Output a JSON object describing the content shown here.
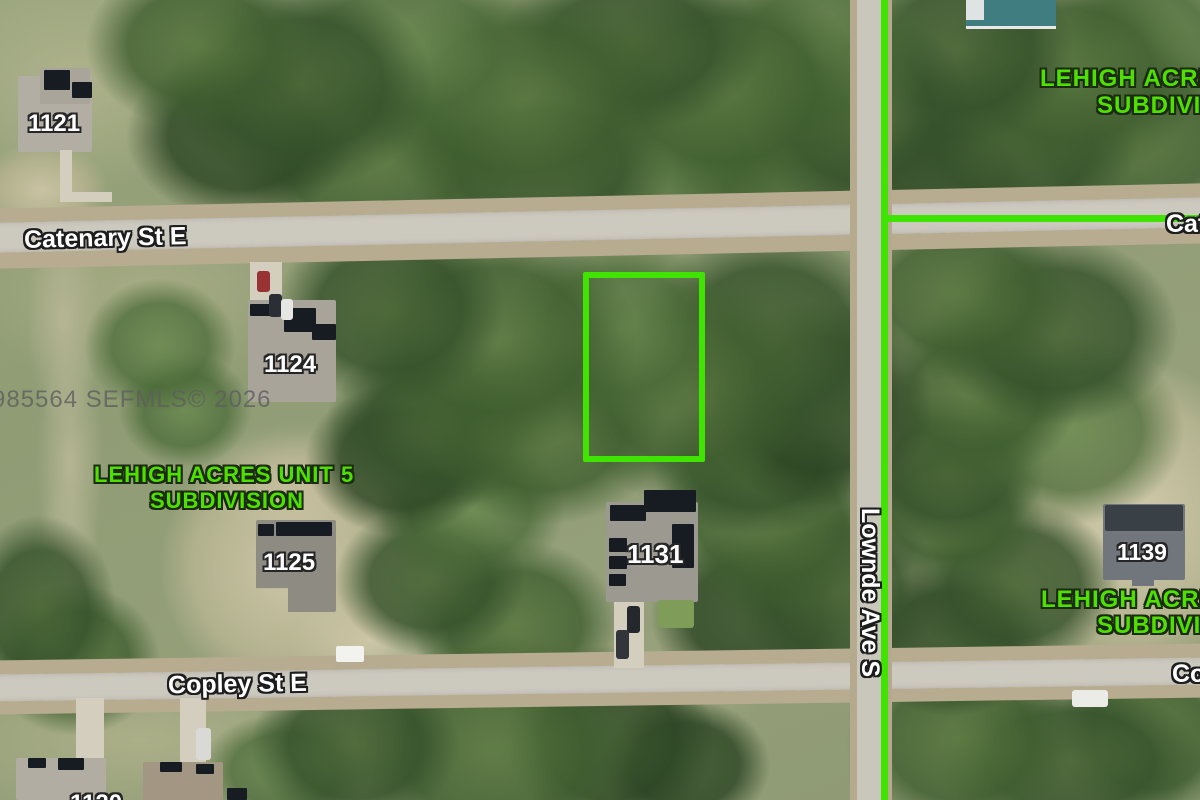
{
  "colors": {
    "annotation_green": "#3FE400",
    "text_green": "#4FDF00",
    "label_white": "#FFFFFF",
    "watermark_gray": "#5E5E5E"
  },
  "watermark": "985564  SEFMLS© 2026",
  "streets": {
    "catenary_west": "Catenary St E",
    "catenary_east": "Catenary St E",
    "copley_west": "Copley St E",
    "copley_east": "Copley St E",
    "lownde": "Lownde Ave S"
  },
  "lot_numbers": {
    "l1121": "1121",
    "l1124": "1124",
    "l1125": "1125",
    "l1131": "1131",
    "l1139": "1139",
    "partial_bottom_left": "1120"
  },
  "subdivision_labels": {
    "center": [
      "LEHIGH ACRES UNIT 5",
      "SUBDIVISION"
    ],
    "top_right": [
      "LEHIGH ACRES",
      "SUBDIVISION"
    ],
    "bottom_right": [
      "LEHIGH ACRES",
      "SUBDIVISION"
    ]
  }
}
